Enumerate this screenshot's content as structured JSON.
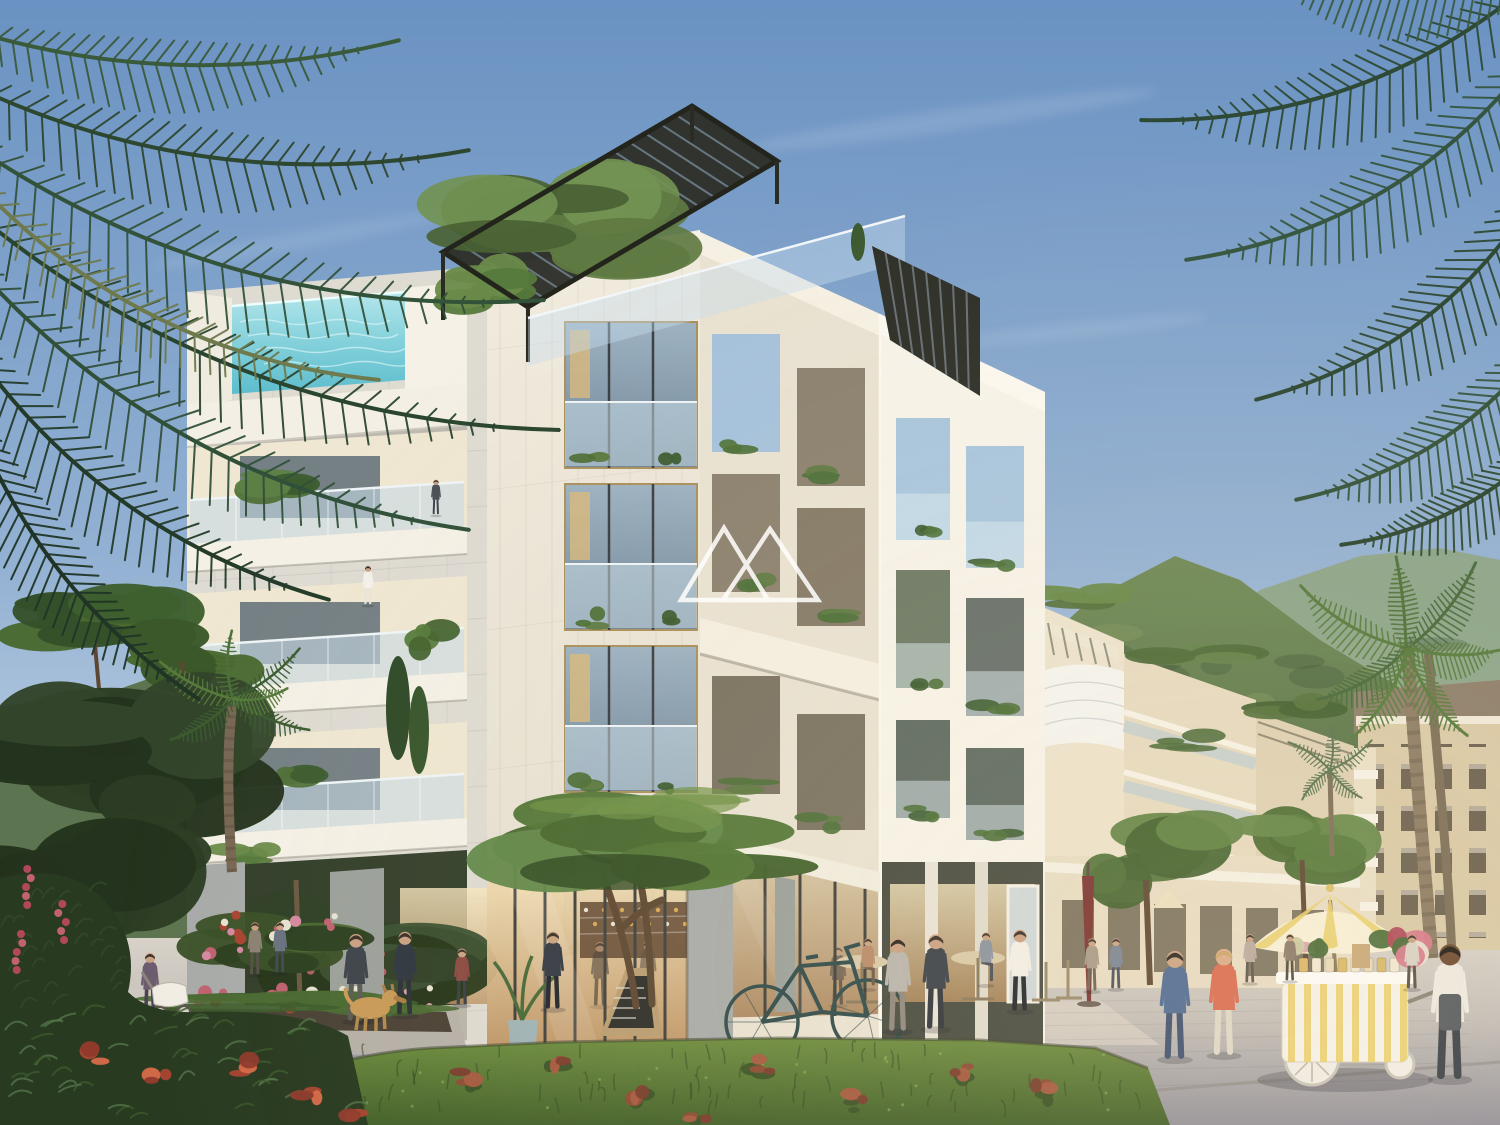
{
  "scene": {
    "type": "architectural-exterior-rendering",
    "setting": "modern seaside apartment complex with rooftop pool, plaza cafe, palms and green mountains",
    "watermark": {
      "name": "twin-mountain-logo",
      "color": "#ffffff",
      "opacity": 0.88
    }
  },
  "palette": {
    "sky_top": "#6a92c2",
    "sky_mid": "#93b1d3",
    "sky_horizon": "#c9d8e6",
    "mountain_far": "#8ba383",
    "mountain_lit": "#6f8a57",
    "mountain_main": "#46603c",
    "mountain_left": "#5d7450",
    "face_sunlit": "#f7f3e9",
    "face_front": "#e9e2d2",
    "tower_top": "#f1ebde",
    "tower_bottom": "#e4decf",
    "wall_shade": "#dedbd2",
    "parapet": "#f6f2e8",
    "pillar": "#a8aba9",
    "pool_water": "#7fd0db",
    "glass": "#b7cbd8",
    "pergola": "#2e3029",
    "interior_top": "#f7e7bf",
    "interior_bottom": "#bb9161",
    "pavement_light": "#d8d2c9",
    "pavement_mid": "#c2bdb8",
    "pavement_dark": "#93919a",
    "grass_light": "#6c8c3e",
    "grass_dark": "#43602a",
    "foliage_dark": "#2d4730",
    "foliage_mid": "#4d7038",
    "foliage_light": "#7a9a55",
    "flower_pink": "#c06270",
    "flower_red": "#a84432",
    "hotel_facade": "#d9c9a7",
    "hotel_roof": "#8d7e6b"
  },
  "objects": {
    "flower_cart": {
      "body": "#f6f3ea",
      "stripe": "#e9cf6e",
      "wheel": "#f1eee6"
    },
    "cart_umbrella": {
      "cream": "#f6efd8",
      "stripe": "#e9cf6e",
      "pole": "#8a7a5a"
    },
    "closed_umbrella": "#7a3332",
    "chalkboard": {
      "frame": "#b89d72",
      "board": "#2d2f2a"
    },
    "bicycle": "#2f4a4a",
    "dog": "#c99a58",
    "stroller": "#f1ede4"
  },
  "people": [
    {
      "name": "pedestrian",
      "x": 88,
      "y": 1004,
      "h": 60,
      "top": "#c9c3b8",
      "bottom": "#8a7e6e"
    },
    {
      "name": "pedestrian",
      "x": 112,
      "y": 1006,
      "h": 62,
      "top": "#5a6475",
      "bottom": "#3e4450"
    },
    {
      "name": "stroller-mother",
      "x": 150,
      "y": 1016,
      "h": 66,
      "top": "#6b5d6e",
      "bottom": "#4a4452"
    },
    {
      "name": "pedestrian-backpack",
      "x": 356,
      "y": 1020,
      "h": 90,
      "top": "#3d434b",
      "bottom": "#5a5c52"
    },
    {
      "name": "pedestrian",
      "x": 405,
      "y": 1014,
      "h": 86,
      "top": "#2e3640",
      "bottom": "#2c3038"
    },
    {
      "name": "pedestrian",
      "x": 462,
      "y": 1004,
      "h": 58,
      "top": "#8a4a42",
      "bottom": "#3a3e46"
    },
    {
      "name": "pedestrian",
      "x": 553,
      "y": 1008,
      "h": 80,
      "top": "#343a44",
      "bottom": "#23262c"
    },
    {
      "name": "cafe-guest-seated",
      "x": 868,
      "y": 988,
      "h": 52,
      "top": "#b98a6a",
      "bottom": "#6a5a48",
      "seated": true
    },
    {
      "name": "cafe-guest-seated",
      "x": 986,
      "y": 984,
      "h": 54,
      "top": "#8a93a0",
      "bottom": "#4a4e58",
      "seated": true
    },
    {
      "name": "waiter",
      "x": 1020,
      "y": 1010,
      "h": 84,
      "top": "#f2efe8",
      "bottom": "#23262b"
    },
    {
      "name": "woman-gray-suit",
      "x": 898,
      "y": 1030,
      "h": 96,
      "top": "#b9b4ad",
      "bottom": "#8e887e",
      "hair": "#2c2620"
    },
    {
      "name": "man-dark-suit",
      "x": 936,
      "y": 1028,
      "h": 98,
      "top": "#3a4048",
      "bottom": "#30343c"
    },
    {
      "name": "pedestrian-distant",
      "x": 1092,
      "y": 990,
      "h": 54,
      "top": "#a89a88",
      "bottom": "#6a6258"
    },
    {
      "name": "pedestrian-distant",
      "x": 1116,
      "y": 988,
      "h": 52,
      "top": "#7a8494",
      "bottom": "#4a5060"
    },
    {
      "name": "pedestrian-distant",
      "x": 1250,
      "y": 982,
      "h": 50,
      "top": "#b9a8a0",
      "bottom": "#5c544c"
    },
    {
      "name": "pedestrian-distant",
      "x": 1290,
      "y": 980,
      "h": 48,
      "top": "#8a7a6a",
      "bottom": "#4e4840"
    },
    {
      "name": "pedestrian-distant",
      "x": 1412,
      "y": 988,
      "h": 56,
      "top": "#d8d2c6",
      "bottom": "#5a5248"
    },
    {
      "name": "man-blue-jacket",
      "x": 1175,
      "y": 1058,
      "h": 112,
      "top": "#4e6a94",
      "bottom": "#3d5070",
      "hair": "#2a2620"
    },
    {
      "name": "woman-coral-blazer",
      "x": 1224,
      "y": 1054,
      "h": 110,
      "top": "#d96a50",
      "bottom": "#ded8c8",
      "hair": "#caa26a",
      "skin": "#d9ab88"
    },
    {
      "name": "cart-vendor",
      "x": 1450,
      "y": 1078,
      "h": 140,
      "top": "#edeae2",
      "bottom": "#3a4048",
      "apron": "#565b60",
      "skin": "#6e4a32",
      "hair": "#1f1a16"
    },
    {
      "name": "balcony-resident",
      "x": 436,
      "y": 514,
      "h": 36,
      "top": "#4a5058",
      "bottom": "#3e444c"
    },
    {
      "name": "balcony-resident",
      "x": 368,
      "y": 604,
      "h": 40,
      "top": "#f2f0ea",
      "bottom": "#e8e4da",
      "hair": "#3a2e26"
    },
    {
      "name": "pedestrian-distant",
      "x": 255,
      "y": 974,
      "h": 54,
      "top": "#8a8274",
      "bottom": "#565048"
    },
    {
      "name": "pedestrian-distant",
      "x": 280,
      "y": 972,
      "h": 52,
      "top": "#6a7280",
      "bottom": "#434a56"
    }
  ]
}
